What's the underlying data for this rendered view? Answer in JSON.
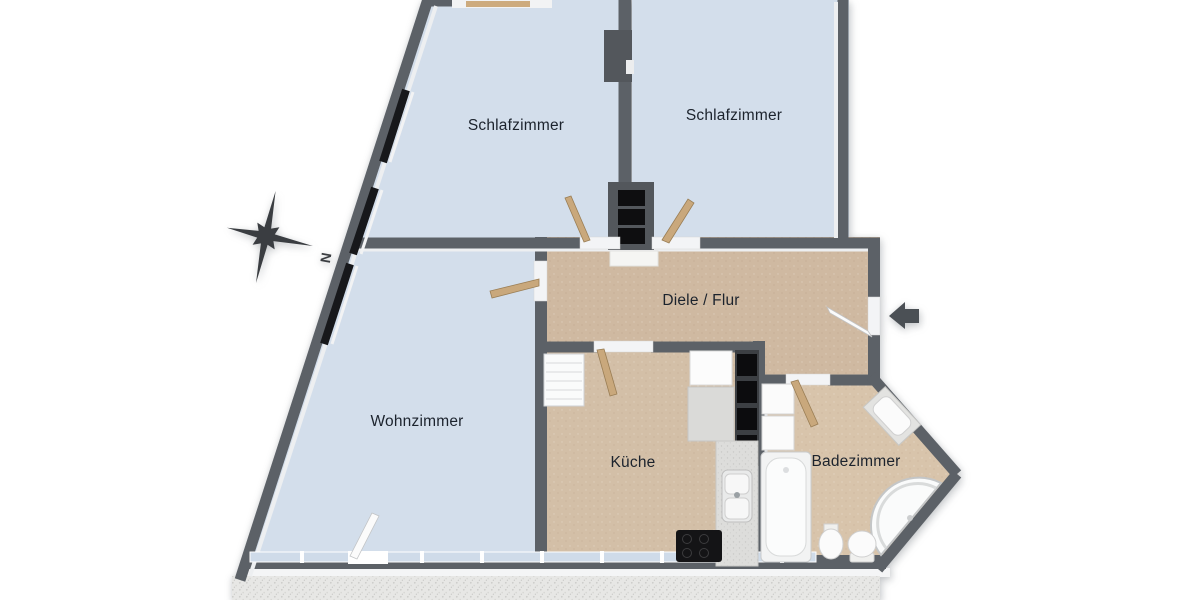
{
  "page": {
    "background": "#ffffff",
    "type": "3d-floor-plan-top-view"
  },
  "rooms": [
    {
      "id": "schlafzimmer-left",
      "label": "Schlafzimmer",
      "floor_color": "#d3deeb"
    },
    {
      "id": "schlafzimmer-right",
      "label": "Schlafzimmer",
      "floor_color": "#d3deeb"
    },
    {
      "id": "diele-flur",
      "label": "Diele / Flur",
      "floor_color": "#cfb9a1"
    },
    {
      "id": "wohnzimmer",
      "label": "Wohnzimmer",
      "floor_color": "#d3deeb"
    },
    {
      "id": "kueche",
      "label": "Küche",
      "floor_color": "#d3bfa7"
    },
    {
      "id": "badezimmer",
      "label": "Badezimmer",
      "floor_color": "#d8c4ab"
    }
  ],
  "compass": {
    "icon": "compass-rose-icon",
    "north_label": "N",
    "color": "#3a3d41"
  },
  "entrance": {
    "icon": "entrance-arrow-icon",
    "direction": "left",
    "color": "#4b5055"
  },
  "colors": {
    "wall": "#5c6167",
    "wall_dark": "#53575c",
    "wall_lining": "#edeff1",
    "window_glass": "#cfdbe9",
    "window_dark": "#17181b",
    "balcony_gravel": "#e7e7e5",
    "door_wood": "#c9a87c",
    "fixture_white": "#fbfbfb",
    "label_text": "#1c232d"
  },
  "fixtures": [
    "bathtub",
    "corner-shower",
    "toilet",
    "bidet",
    "washbasin",
    "bathroom-cabinet",
    "kitchen-sink",
    "kitchen-counter",
    "cooktop",
    "kitchen-shelf",
    "kitchen-cabinet",
    "radiator",
    "doormat"
  ]
}
